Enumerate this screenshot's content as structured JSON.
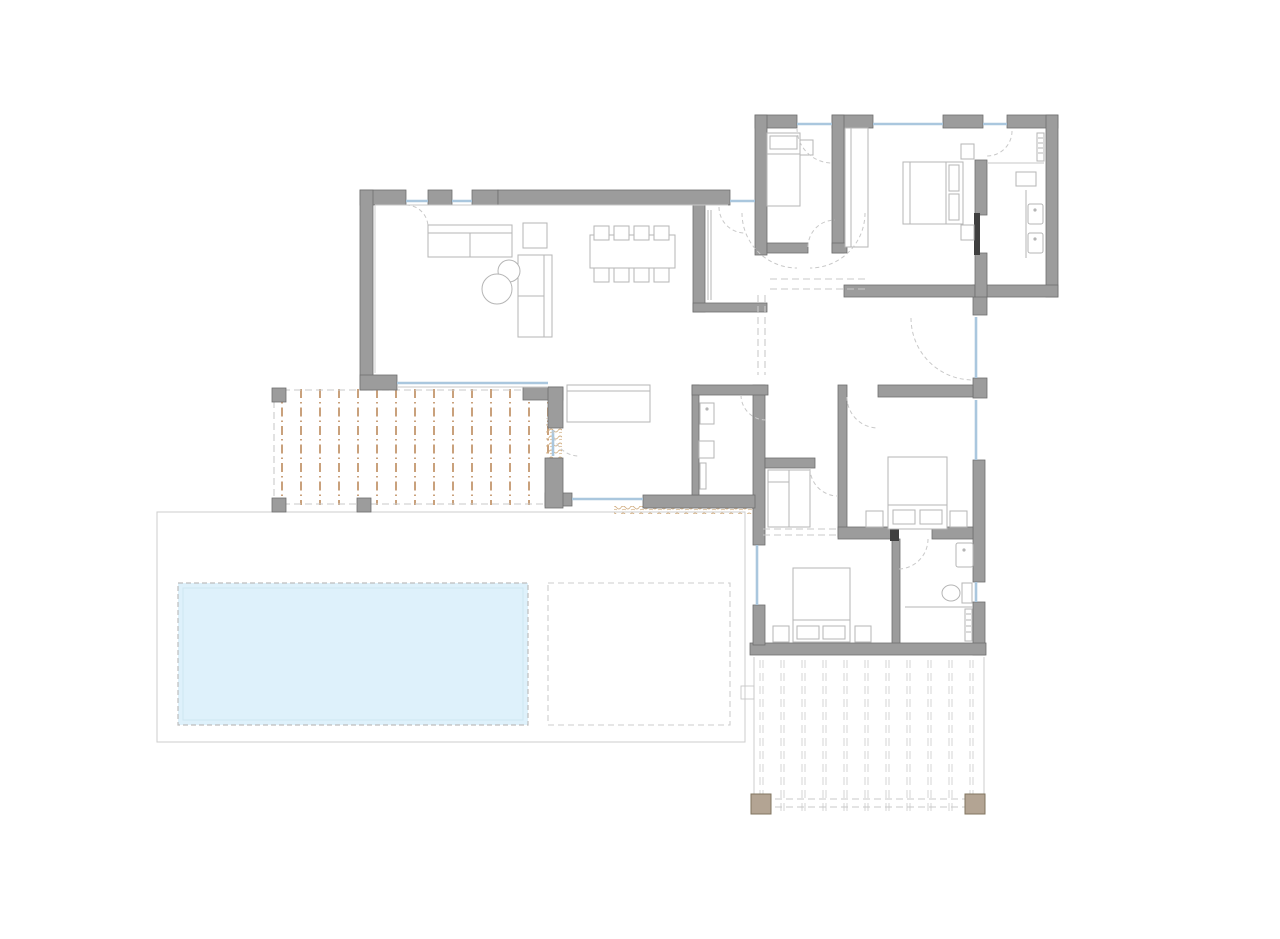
{
  "canvas": {
    "width": 1280,
    "height": 939
  },
  "drawing_type": "architectural-floor-plan",
  "colors": {
    "wall": "#9c9c9c",
    "wall-edge": "#6f6f6f",
    "door-slab": "#3f3f3f",
    "furniture": "#b5b5b5",
    "thin": "#c7c7c7",
    "window": "#aac7de",
    "door-arc": "#c9c9c9",
    "pergola": "#c9a17c",
    "deck-line": "#d4d4d4",
    "pool": "#def1fb",
    "pool-edge": "#bdbdbd",
    "pool-inner": "#cfe6f2",
    "platform-edge": "#cdcdcd",
    "hatch": "#d2af83",
    "post": "#b3a493",
    "post-edge": "#80745f"
  },
  "regions": [
    "living-dining-room",
    "kitchen",
    "pantry",
    "utility-room",
    "entry-hall",
    "corridor",
    "bedroom-1",
    "master-bedroom",
    "ensuite-bathroom",
    "bedroom-2",
    "bedroom-3",
    "bathroom",
    "pergola-terrace",
    "pool-terrace",
    "swimming-pool",
    "rear-deck"
  ],
  "patterns": [
    {
      "host": "pergola-lines",
      "kind": "vline",
      "x0": 282,
      "dx": 19,
      "count": 15,
      "y1": 389,
      "y2": 505,
      "cls": "pergola-line"
    },
    {
      "host": "deck-lines",
      "kind": "vpair",
      "x0": 760,
      "dx": 21,
      "count": 11,
      "gap": 3,
      "y1": 660,
      "y2": 811,
      "cls": "deck-line"
    },
    {
      "host": "dining-chairs-top",
      "kind": "rect-row",
      "x0": 594,
      "dx": 20,
      "count": 4,
      "y": 226,
      "w": 15,
      "h": 14,
      "cls": "furn"
    },
    {
      "host": "dining-chairs-bottom",
      "kind": "rect-row",
      "x0": 594,
      "dx": 20,
      "count": 4,
      "y": 268,
      "w": 15,
      "h": 14,
      "cls": "furn"
    }
  ],
  "furniture": {
    "dining_seats": 8,
    "beds": 4,
    "bathroom_sinks": 3,
    "sofas": 2,
    "coffee_tables": 2
  }
}
